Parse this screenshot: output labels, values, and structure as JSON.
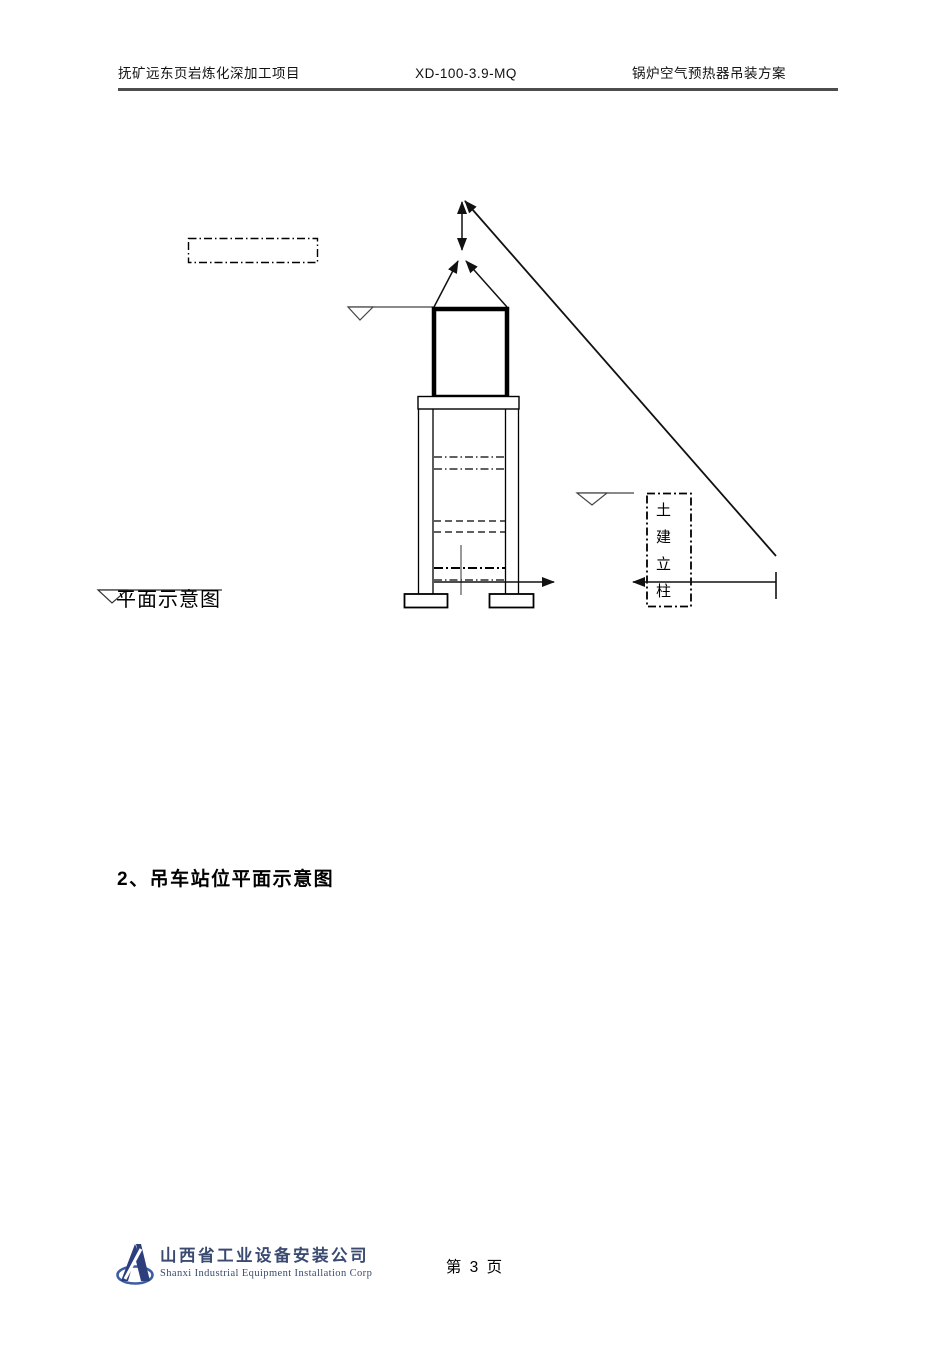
{
  "header": {
    "project_name": "抚矿远东页岩炼化深加工项目",
    "doc_code": "XD-100-3.9-MQ",
    "doc_title": "锅炉空气预热器吊装方案"
  },
  "diagram": {
    "civil_column_label": "土建立柱",
    "caption": "平面示意图"
  },
  "section_heading": "2、吊车站位平面示意图",
  "footer": {
    "company_cn": "山西省工业设备安装公司",
    "company_en": "Shanxi Industrial Equipment Installation Corp",
    "page_label": "第 3 页"
  },
  "colors": {
    "brand_blue": "#2c3e7c",
    "brand_blue_light": "#3d5ca3",
    "footer_text": "#3a4a70",
    "header_rule": "#4d4d4d",
    "line_black": "#000000"
  }
}
